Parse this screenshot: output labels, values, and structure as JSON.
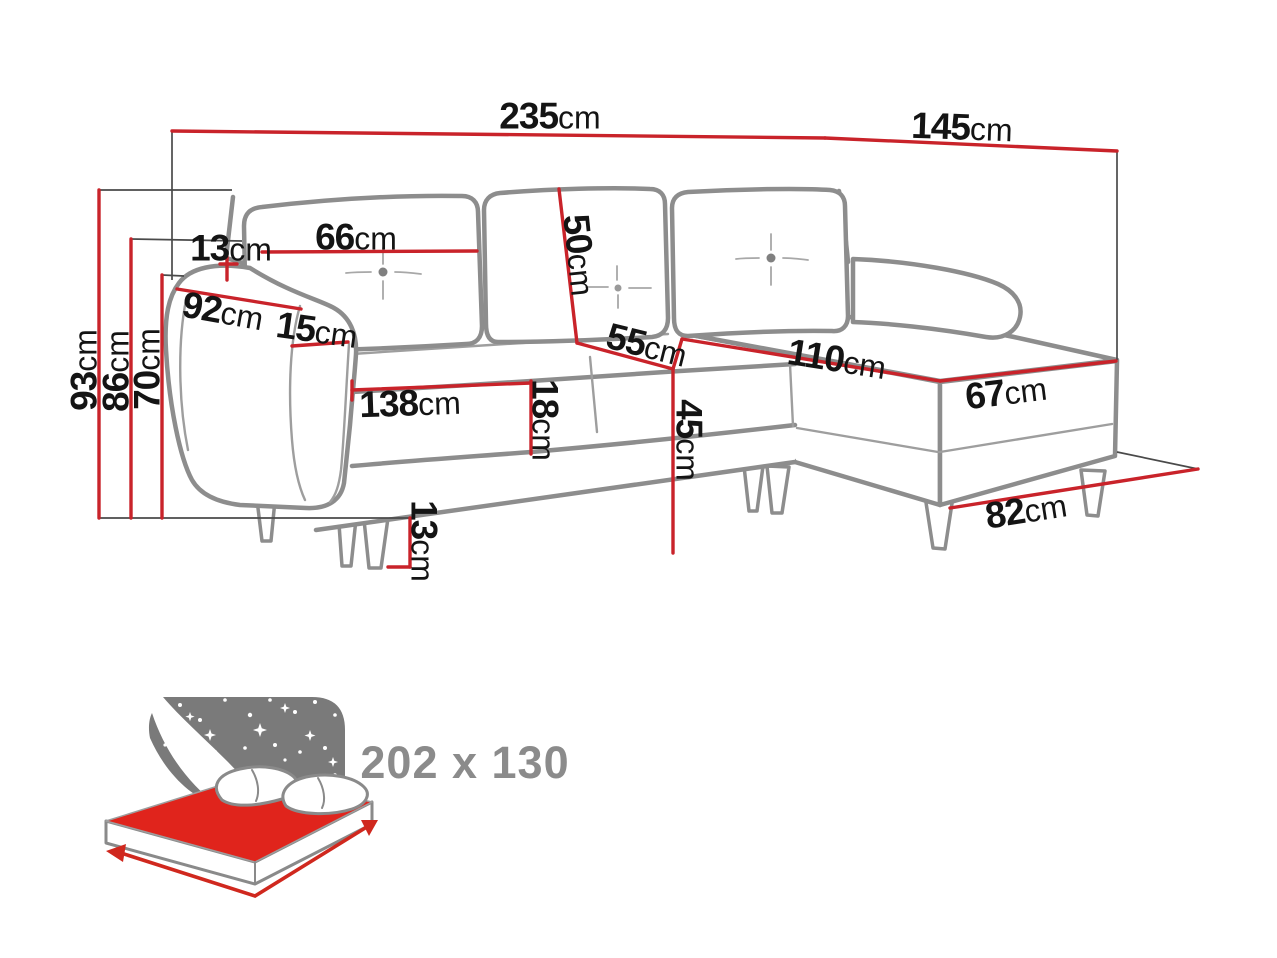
{
  "diagram": {
    "title": "corner-sofa-dimensions",
    "unit": "cm",
    "colors": {
      "dimension_red": "#c9232a",
      "outline_gray": "#8d8d8d",
      "label_black": "#141414",
      "icon_gray": "#7a7a7a",
      "mattress_red": "#e0241c",
      "sleeping_text_gray": "#8b8b8b",
      "background": "#ffffff"
    },
    "dimensions": {
      "total_width": {
        "value": "235",
        "unit": "cm"
      },
      "total_depth": {
        "value": "145",
        "unit": "cm"
      },
      "height_total": {
        "value": "93",
        "unit": "cm"
      },
      "height_backrest": {
        "value": "86",
        "unit": "cm"
      },
      "height_armrest": {
        "value": "70",
        "unit": "cm"
      },
      "backrest_ledge": {
        "value": "13",
        "unit": "cm"
      },
      "back_cushion_width": {
        "value": "66",
        "unit": "cm"
      },
      "back_cushion_height": {
        "value": "50",
        "unit": "cm"
      },
      "seat_depth": {
        "value": "55",
        "unit": "cm"
      },
      "seat_height": {
        "value": "45",
        "unit": "cm"
      },
      "armrest_depth": {
        "value": "92",
        "unit": "cm"
      },
      "armrest_width": {
        "value": "15",
        "unit": "cm"
      },
      "seat_width": {
        "value": "138",
        "unit": "cm"
      },
      "seat_cushion_thickness": {
        "value": "18",
        "unit": "cm"
      },
      "leg_height": {
        "value": "13",
        "unit": "cm"
      },
      "chaise_length": {
        "value": "110",
        "unit": "cm"
      },
      "chaise_width": {
        "value": "67",
        "unit": "cm"
      },
      "chaise_front_width": {
        "value": "82",
        "unit": "cm"
      }
    },
    "sleeping_area": {
      "size_label": "202 x 130"
    }
  }
}
